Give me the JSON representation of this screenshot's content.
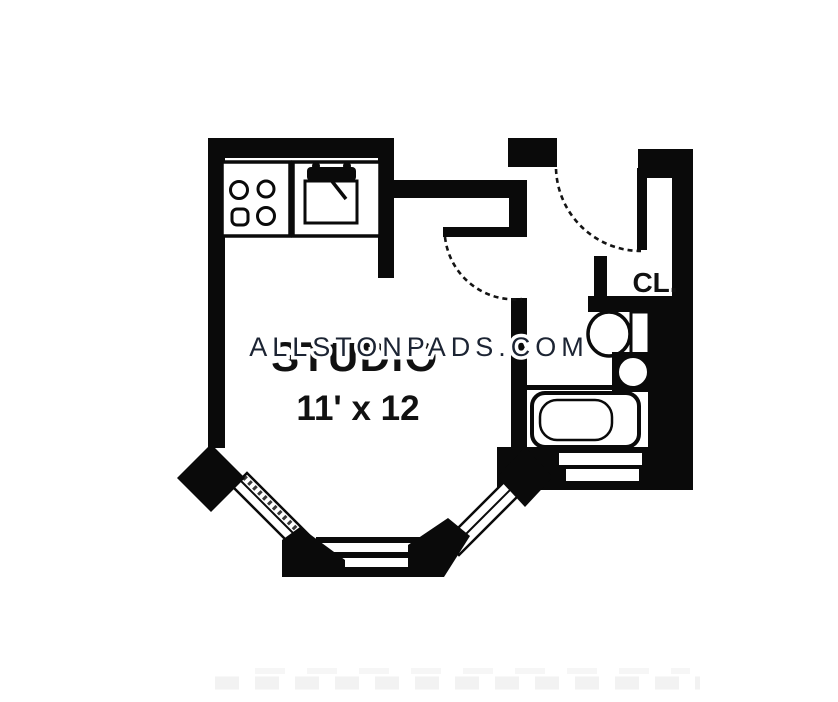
{
  "floorplan": {
    "room_label": "STUDIO",
    "room_dimensions": "11' x 12",
    "closet_label": "CL.",
    "watermark": "ALLSTONPADS.COM",
    "colors": {
      "wall": "#0a0a0a",
      "label": "#111111",
      "watermark": "#1c2433",
      "watermark_halo": "#ffffff"
    }
  }
}
